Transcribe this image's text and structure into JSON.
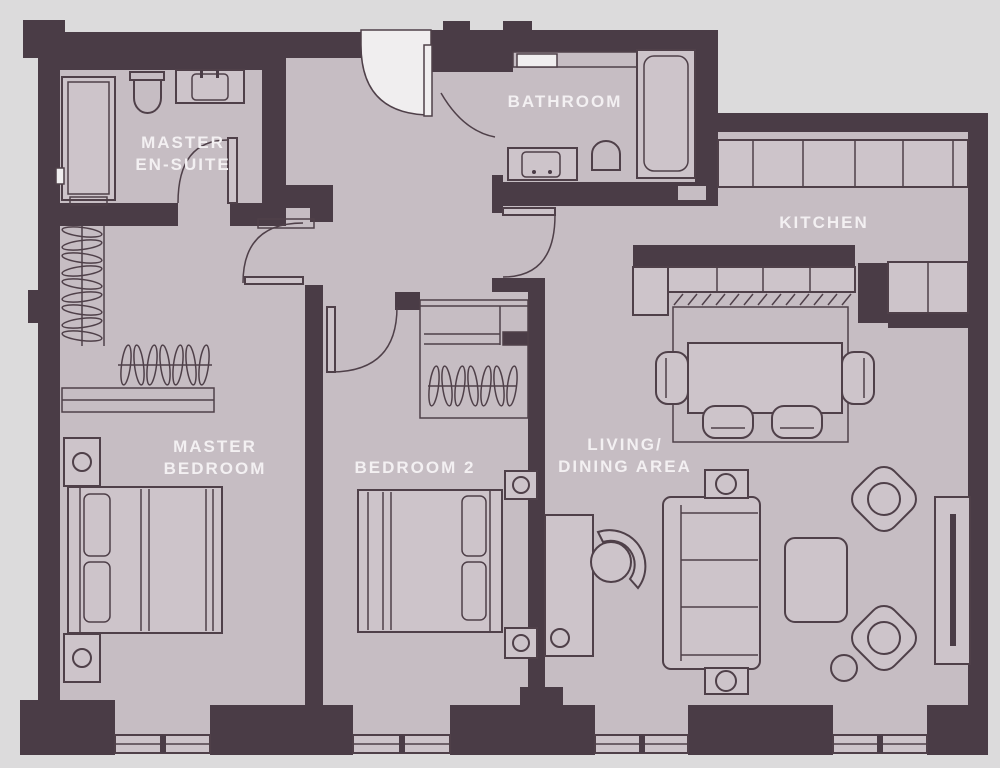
{
  "plan": {
    "type": "apartment-floorplan",
    "colors": {
      "wall": "#4a3c46",
      "floor": "#c6bdc3",
      "floor_light": "#cdc4ca",
      "outside": "#dcdbdc",
      "line": "#4f4049",
      "white": "#f0eeef",
      "label": "#f3f0f2"
    },
    "rooms": [
      {
        "id": "master-ensuite",
        "label_lines": [
          "MASTER",
          "EN-SUITE"
        ]
      },
      {
        "id": "bathroom",
        "label_lines": [
          "BATHROOM"
        ]
      },
      {
        "id": "kitchen",
        "label_lines": [
          "KITCHEN"
        ]
      },
      {
        "id": "master-bedroom",
        "label_lines": [
          "MASTER",
          "BEDROOM"
        ]
      },
      {
        "id": "bedroom-2",
        "label_lines": [
          "BEDROOM 2"
        ]
      },
      {
        "id": "living-dining",
        "label_lines": [
          "LIVING/",
          "DINING AREA"
        ]
      }
    ]
  }
}
